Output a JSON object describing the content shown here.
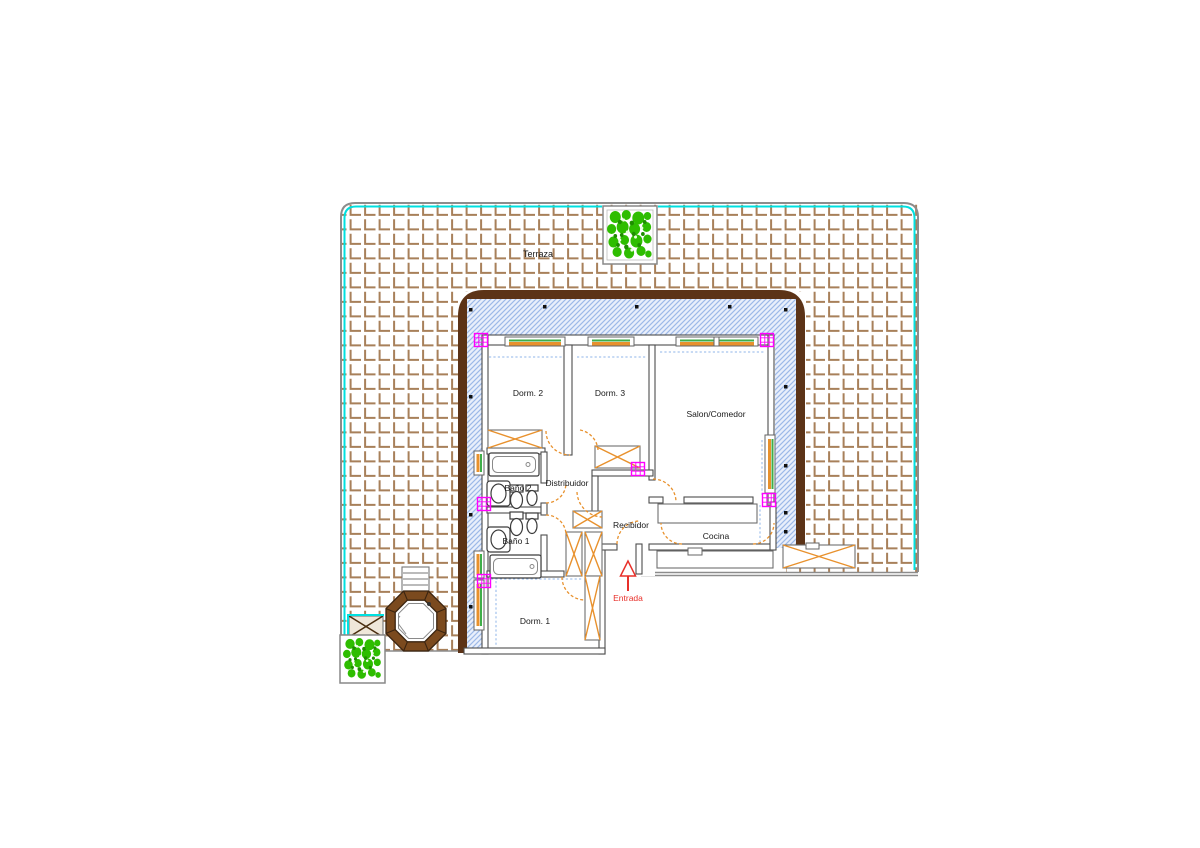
{
  "drawing": {
    "type": "floor-plan",
    "rooms": [
      {
        "id": "terraza",
        "label": "Terraza"
      },
      {
        "id": "dorm2",
        "label": "Dorm. 2"
      },
      {
        "id": "dorm3",
        "label": "Dorm. 3"
      },
      {
        "id": "salon",
        "label": "Salon/Comedor"
      },
      {
        "id": "distribuidor",
        "label": "Distribuidor"
      },
      {
        "id": "bano2",
        "label": "Baño 2"
      },
      {
        "id": "bano1",
        "label": "Baño 1"
      },
      {
        "id": "recibidor",
        "label": "Recibidor"
      },
      {
        "id": "cocina",
        "label": "Cocina"
      },
      {
        "id": "dorm1",
        "label": "Dorm. 1"
      }
    ],
    "entrance_label": "Entrada"
  },
  "colors": {
    "wallBrown": "#5C3317",
    "boundaryCyan": "#00E0E0",
    "tileBrown": "#A8805A",
    "hatchBlue": "#9DB9E8",
    "hatchBg": "#E9EFFB",
    "accentOrange": "#E8912D",
    "windowGreen": "#3FAE49",
    "markerMagenta": "#FF00FF",
    "entranceRed": "#E8302A",
    "plantGreen": "#2EBD00",
    "plantDark": "#1E8F00",
    "outlineGray": "#8C8C8C",
    "wallLineGray": "#4D4D4D",
    "hotTubBrown": "#7B4A1E",
    "hotTubDark": "#3A2410",
    "dashBlue": "#8FB4E8",
    "textDark": "#1A1A1A"
  }
}
